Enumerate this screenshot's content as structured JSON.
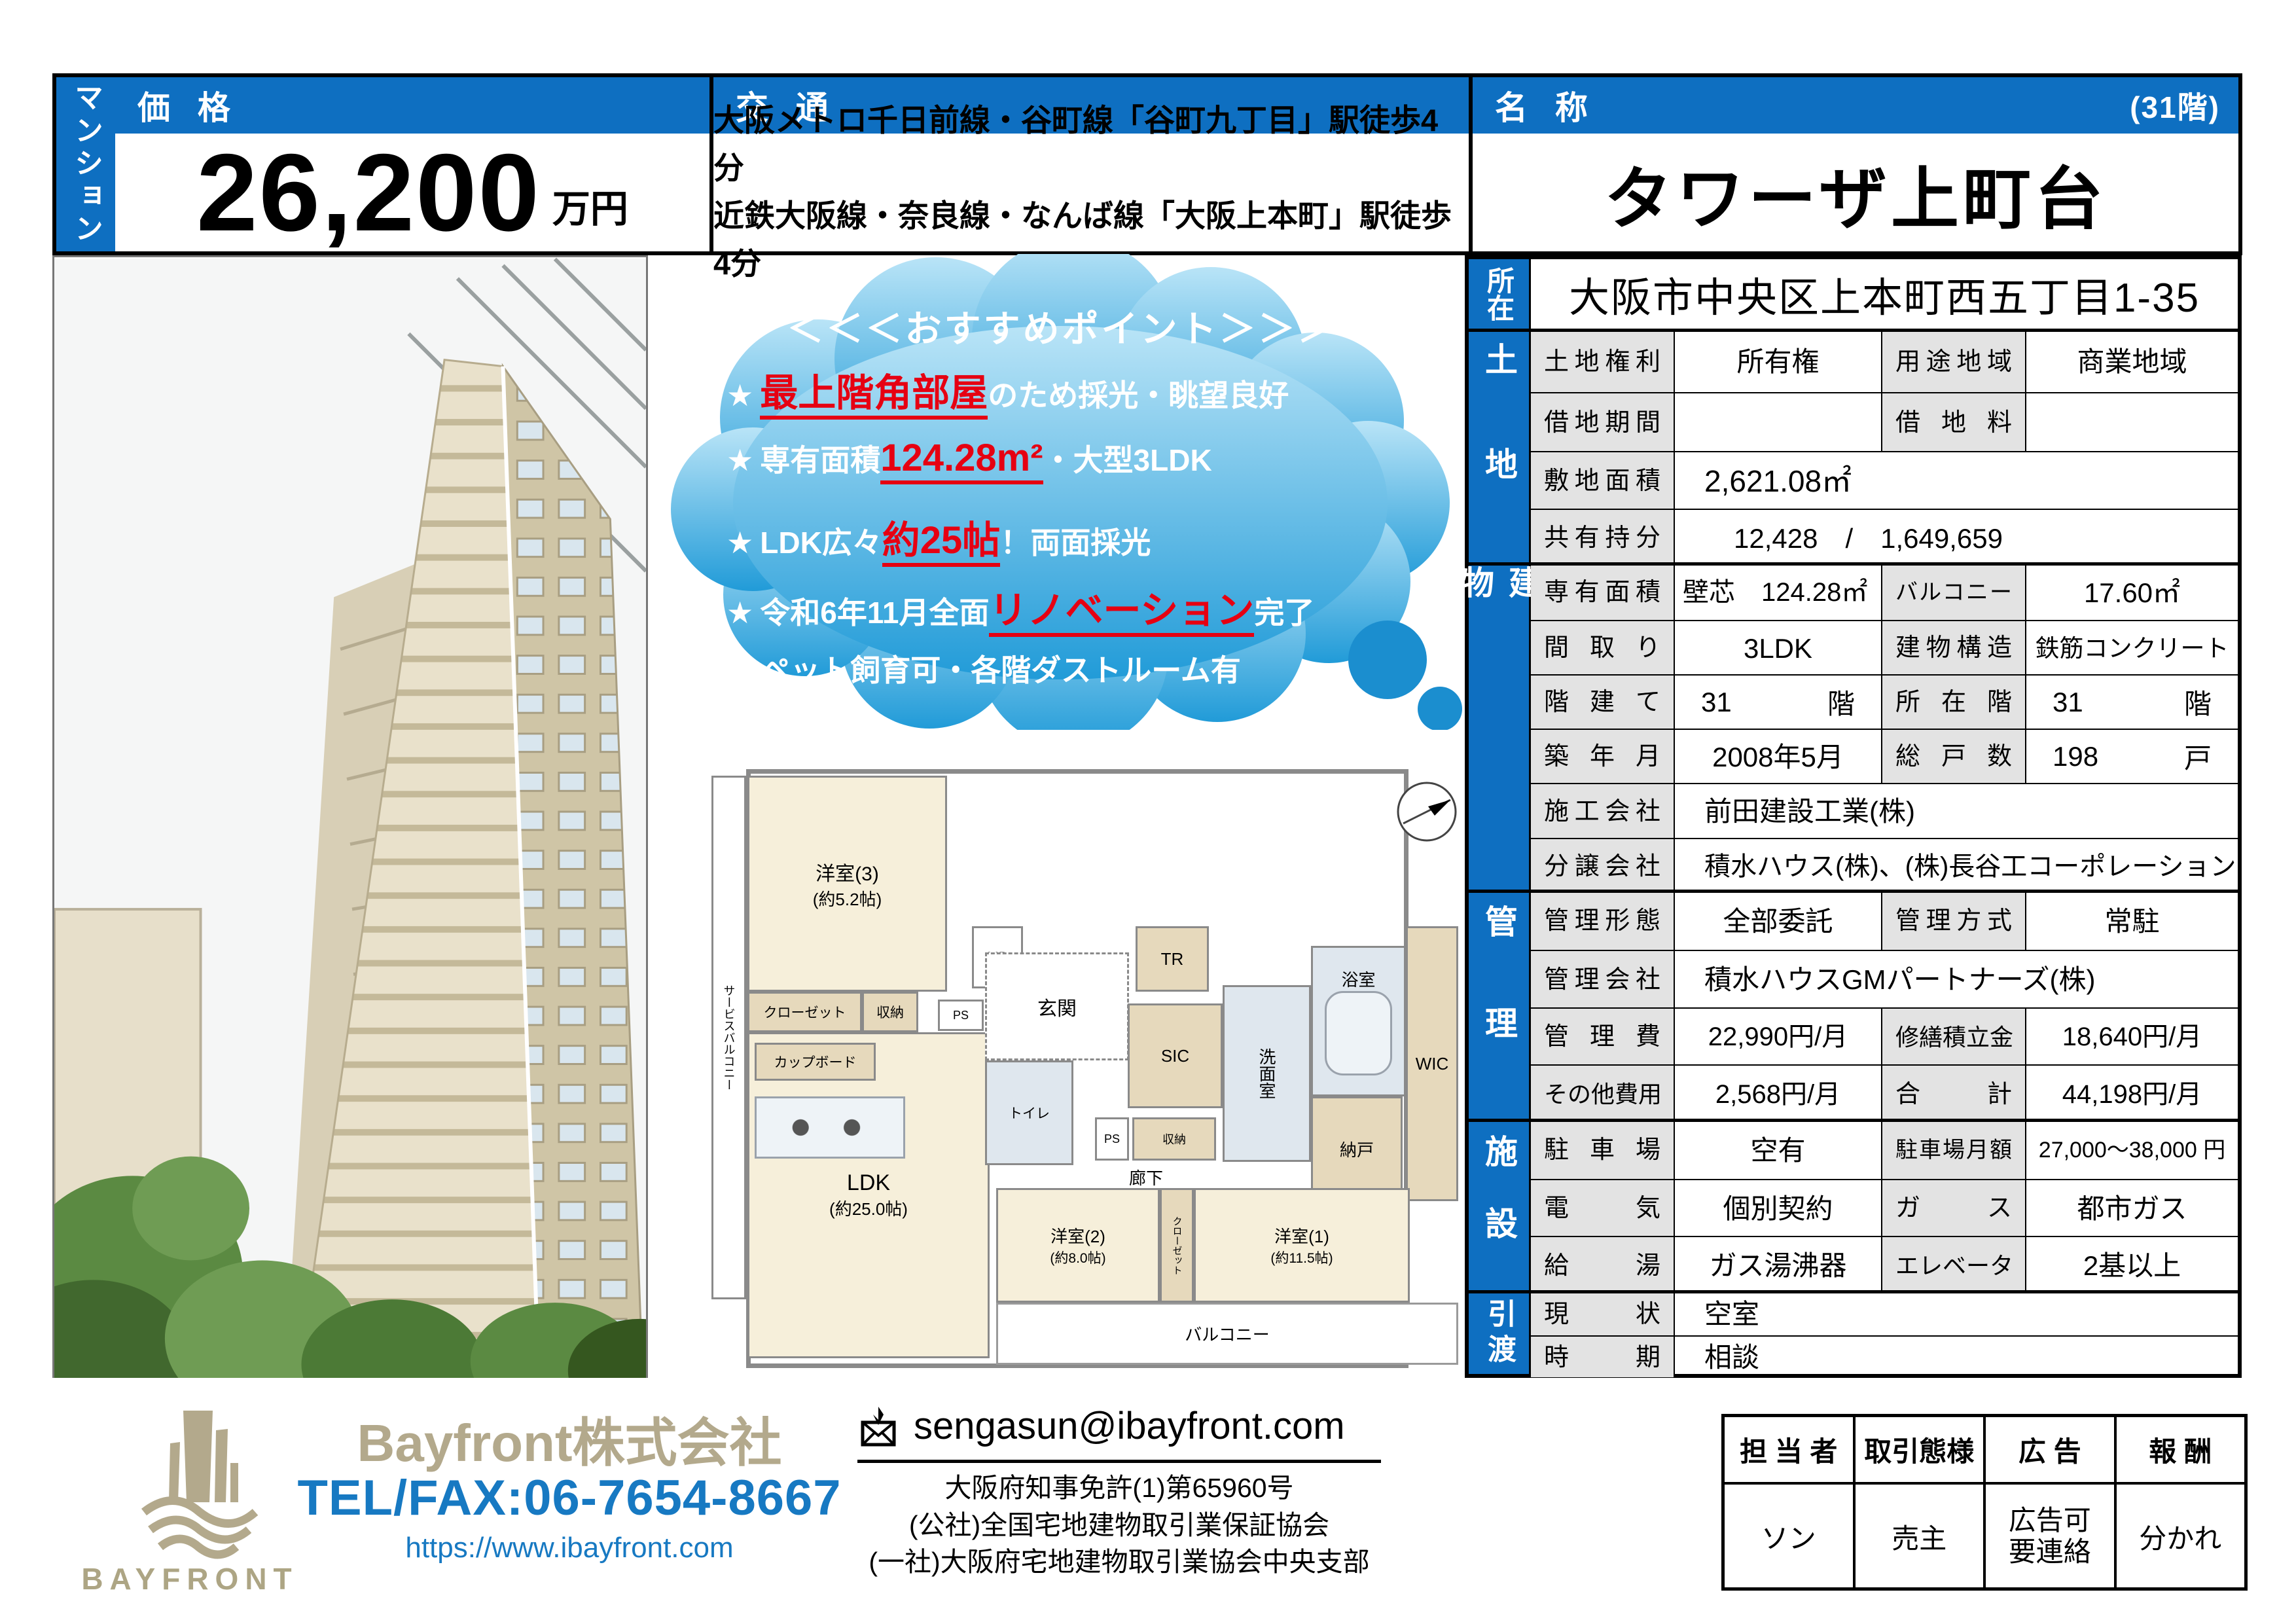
{
  "side_tab": "マンション",
  "price": {
    "header": "価 格",
    "value": "26,200",
    "unit": "万円"
  },
  "access": {
    "header": "交 通",
    "lines": [
      "大阪メトロ千日前線・谷町線「谷町九丁目」駅徒歩4分",
      "近鉄大阪線・奈良線・なんば線「大阪上本町」駅徒歩4分"
    ]
  },
  "name": {
    "header": "名 称",
    "floor": "(31階)",
    "value": "タワーザ上町台"
  },
  "recommend": {
    "title": "＜＜＜おすすめポイント＞＞＞",
    "points": [
      {
        "star": "★",
        "pre": "",
        "hl": "最上階角部屋",
        "post": "のため採光・眺望良好"
      },
      {
        "star": "★",
        "pre": "専有面積",
        "hl": "124.28m²",
        "post": "・大型3LDK"
      },
      {
        "star": "★",
        "pre": "LDK広々",
        "hl": "約25帖",
        "post": "！両面採光"
      },
      {
        "star": "★",
        "pre": "令和6年11月全面",
        "hl": "リノベーション",
        "post": "完了"
      },
      {
        "star": "★",
        "pre": "ペット飼育可・各階ダストルーム有",
        "hl": "",
        "post": ""
      }
    ]
  },
  "info": {
    "location": {
      "tab": "所在",
      "address": "大阪市中央区上本町西五丁目1-35"
    },
    "land": {
      "tab": "土地",
      "r1": {
        "l1": "土地権利",
        "v1": "所有権",
        "l2": "用途地域",
        "v2": "商業地域"
      },
      "r2": {
        "l1": "借地期間",
        "v1": "",
        "l2": "借地料",
        "v2": ""
      },
      "r3": {
        "l": "敷地面積",
        "v": "2,621.08㎡"
      },
      "r4": {
        "l": "共有持分",
        "v": "12,428　/　1,649,659"
      }
    },
    "building": {
      "tab": "建物",
      "r1": {
        "l1": "専有面積",
        "v1": "壁芯　124.28㎡",
        "l2": "バルコニー",
        "v2": "17.60㎡"
      },
      "r2": {
        "l1": "間取り",
        "v1": "3LDK",
        "l2": "建物構造",
        "v2": "鉄筋コンクリート"
      },
      "r3": {
        "l1": "階建て",
        "v1n": "31",
        "v1u": "階",
        "l2": "所在階",
        "v2n": "31",
        "v2u": "階"
      },
      "r4": {
        "l1": "築年月",
        "v1": "2008年5月",
        "l2": "総戸数",
        "v2n": "198",
        "v2u": "戸"
      },
      "r5": {
        "l": "施工会社",
        "v": "前田建設工業(株)"
      },
      "r6": {
        "l": "分譲会社",
        "v": "積水ハウス(株)、(株)長谷工コーポレーション"
      }
    },
    "management": {
      "tab": "管理",
      "r1": {
        "l1": "管理形態",
        "v1": "全部委託",
        "l2": "管理方式",
        "v2": "常駐"
      },
      "r2": {
        "l": "管理会社",
        "v": "積水ハウスGMパートナーズ(株)"
      },
      "r3": {
        "l1": "管理費",
        "v1": "22,990円/月",
        "l2": "修繕積立金",
        "v2": "18,640円/月"
      },
      "r4": {
        "l1": "その他費用",
        "v1": "2,568円/月",
        "l2": "合計",
        "v2": "44,198円/月"
      }
    },
    "facility": {
      "tab": "施設",
      "r1": {
        "l1": "駐車場",
        "v1": "空有",
        "l2": "駐車場月額",
        "v2": "27,000～38,000 円"
      },
      "r2": {
        "l1": "電気",
        "v1": "個別契約",
        "l2": "ガス",
        "v2": "都市ガス"
      },
      "r3": {
        "l1": "給湯",
        "v1": "ガス湯沸器",
        "l2": "エレベータ",
        "v2": "2基以上"
      }
    },
    "handover": {
      "tab": "引渡",
      "r1": {
        "l": "現状",
        "v": "空室"
      },
      "r2": {
        "l": "時期",
        "v": "相談"
      }
    }
  },
  "plan": {
    "room3": "洋室(3)",
    "room3_size": "(約5.2帖)",
    "room2": "洋室(2)",
    "room2_size": "(約8.0帖)",
    "room1": "洋室(1)",
    "room1_size": "(約11.5帖)",
    "ldk": "LDK",
    "ldk_size": "(約25.0帖)",
    "balcony": "バルコニー",
    "service_balcony": "サービスバルコニー",
    "genkan": "玄関",
    "hallway": "廊下",
    "toilet": "トイレ",
    "washroom": "洗面室",
    "bathroom": "浴室",
    "wic": "WIC",
    "storage_room": "納戸",
    "sic": "SIC",
    "tr": "TR",
    "mb": "MB",
    "ps": "PS",
    "closet": "クローゼット",
    "shuno": "収納",
    "cupboard": "カップボード"
  },
  "footer": {
    "logo_text": "BAYFRONT",
    "company": "Bayfront株式会社",
    "tel": "TEL/FAX:06-7654-8667",
    "url": "https://www.ibayfront.com",
    "email": "sengasun@ibayfront.com",
    "licenses": [
      "大阪府知事免許(1)第65960号",
      "(公社)全国宅地建物取引業保証協会",
      "(一社)大阪府宅地建物取引業協会中央支部"
    ],
    "agent": {
      "h": [
        "担 当 者",
        "取引態様",
        "広 告",
        "報 酬"
      ],
      "staff": "ソン",
      "type": "売主",
      "ad1": "広告可",
      "ad2": "要連絡",
      "fee": "分かれ"
    }
  },
  "colors": {
    "header_blue": "#0e6fc1",
    "highlight_red": "#e60012",
    "brand_tan": "#b3a98c",
    "tel_blue": "#1779c2"
  }
}
